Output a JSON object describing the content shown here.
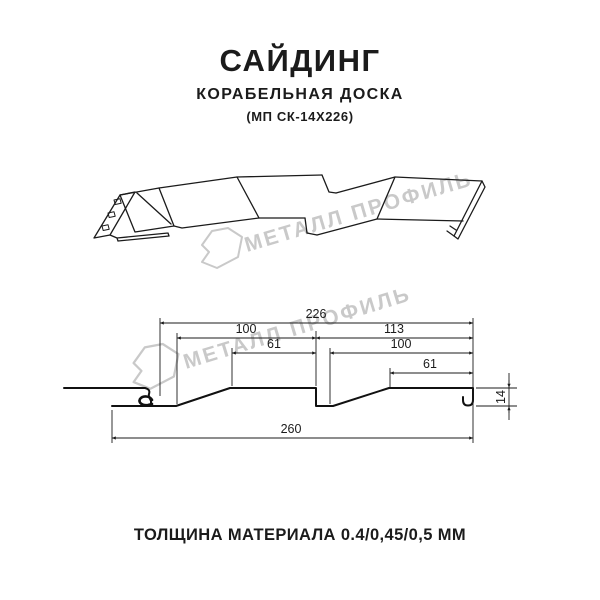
{
  "header": {
    "title": "САЙДИНГ",
    "subtitle": "КОРАБЕЛЬНАЯ ДОСКА",
    "code": "(МП СК-14Х226)"
  },
  "watermark": {
    "text": "МЕТАЛЛ ПРОФИЛЬ",
    "color": "#c9c9c9"
  },
  "drawing": {
    "views": [
      "3d-perspective-panel",
      "cross-section-profile"
    ],
    "product": "siding panel ship-board profile with perforated nail strip"
  },
  "cross_section": {
    "dims": {
      "top_width": "226",
      "left_span": "100",
      "right_span": "113",
      "left_flat": "61",
      "right_inner": "100",
      "right_flat": "61",
      "total_width": "260",
      "height": "14"
    }
  },
  "footer": {
    "thickness": "ТОЛЩИНА МАТЕРИАЛА 0.4/0,45/0,5 ММ"
  },
  "colors": {
    "line": "#1b1b1b",
    "watermark": "#c9c9c9",
    "background": "#ffffff"
  }
}
